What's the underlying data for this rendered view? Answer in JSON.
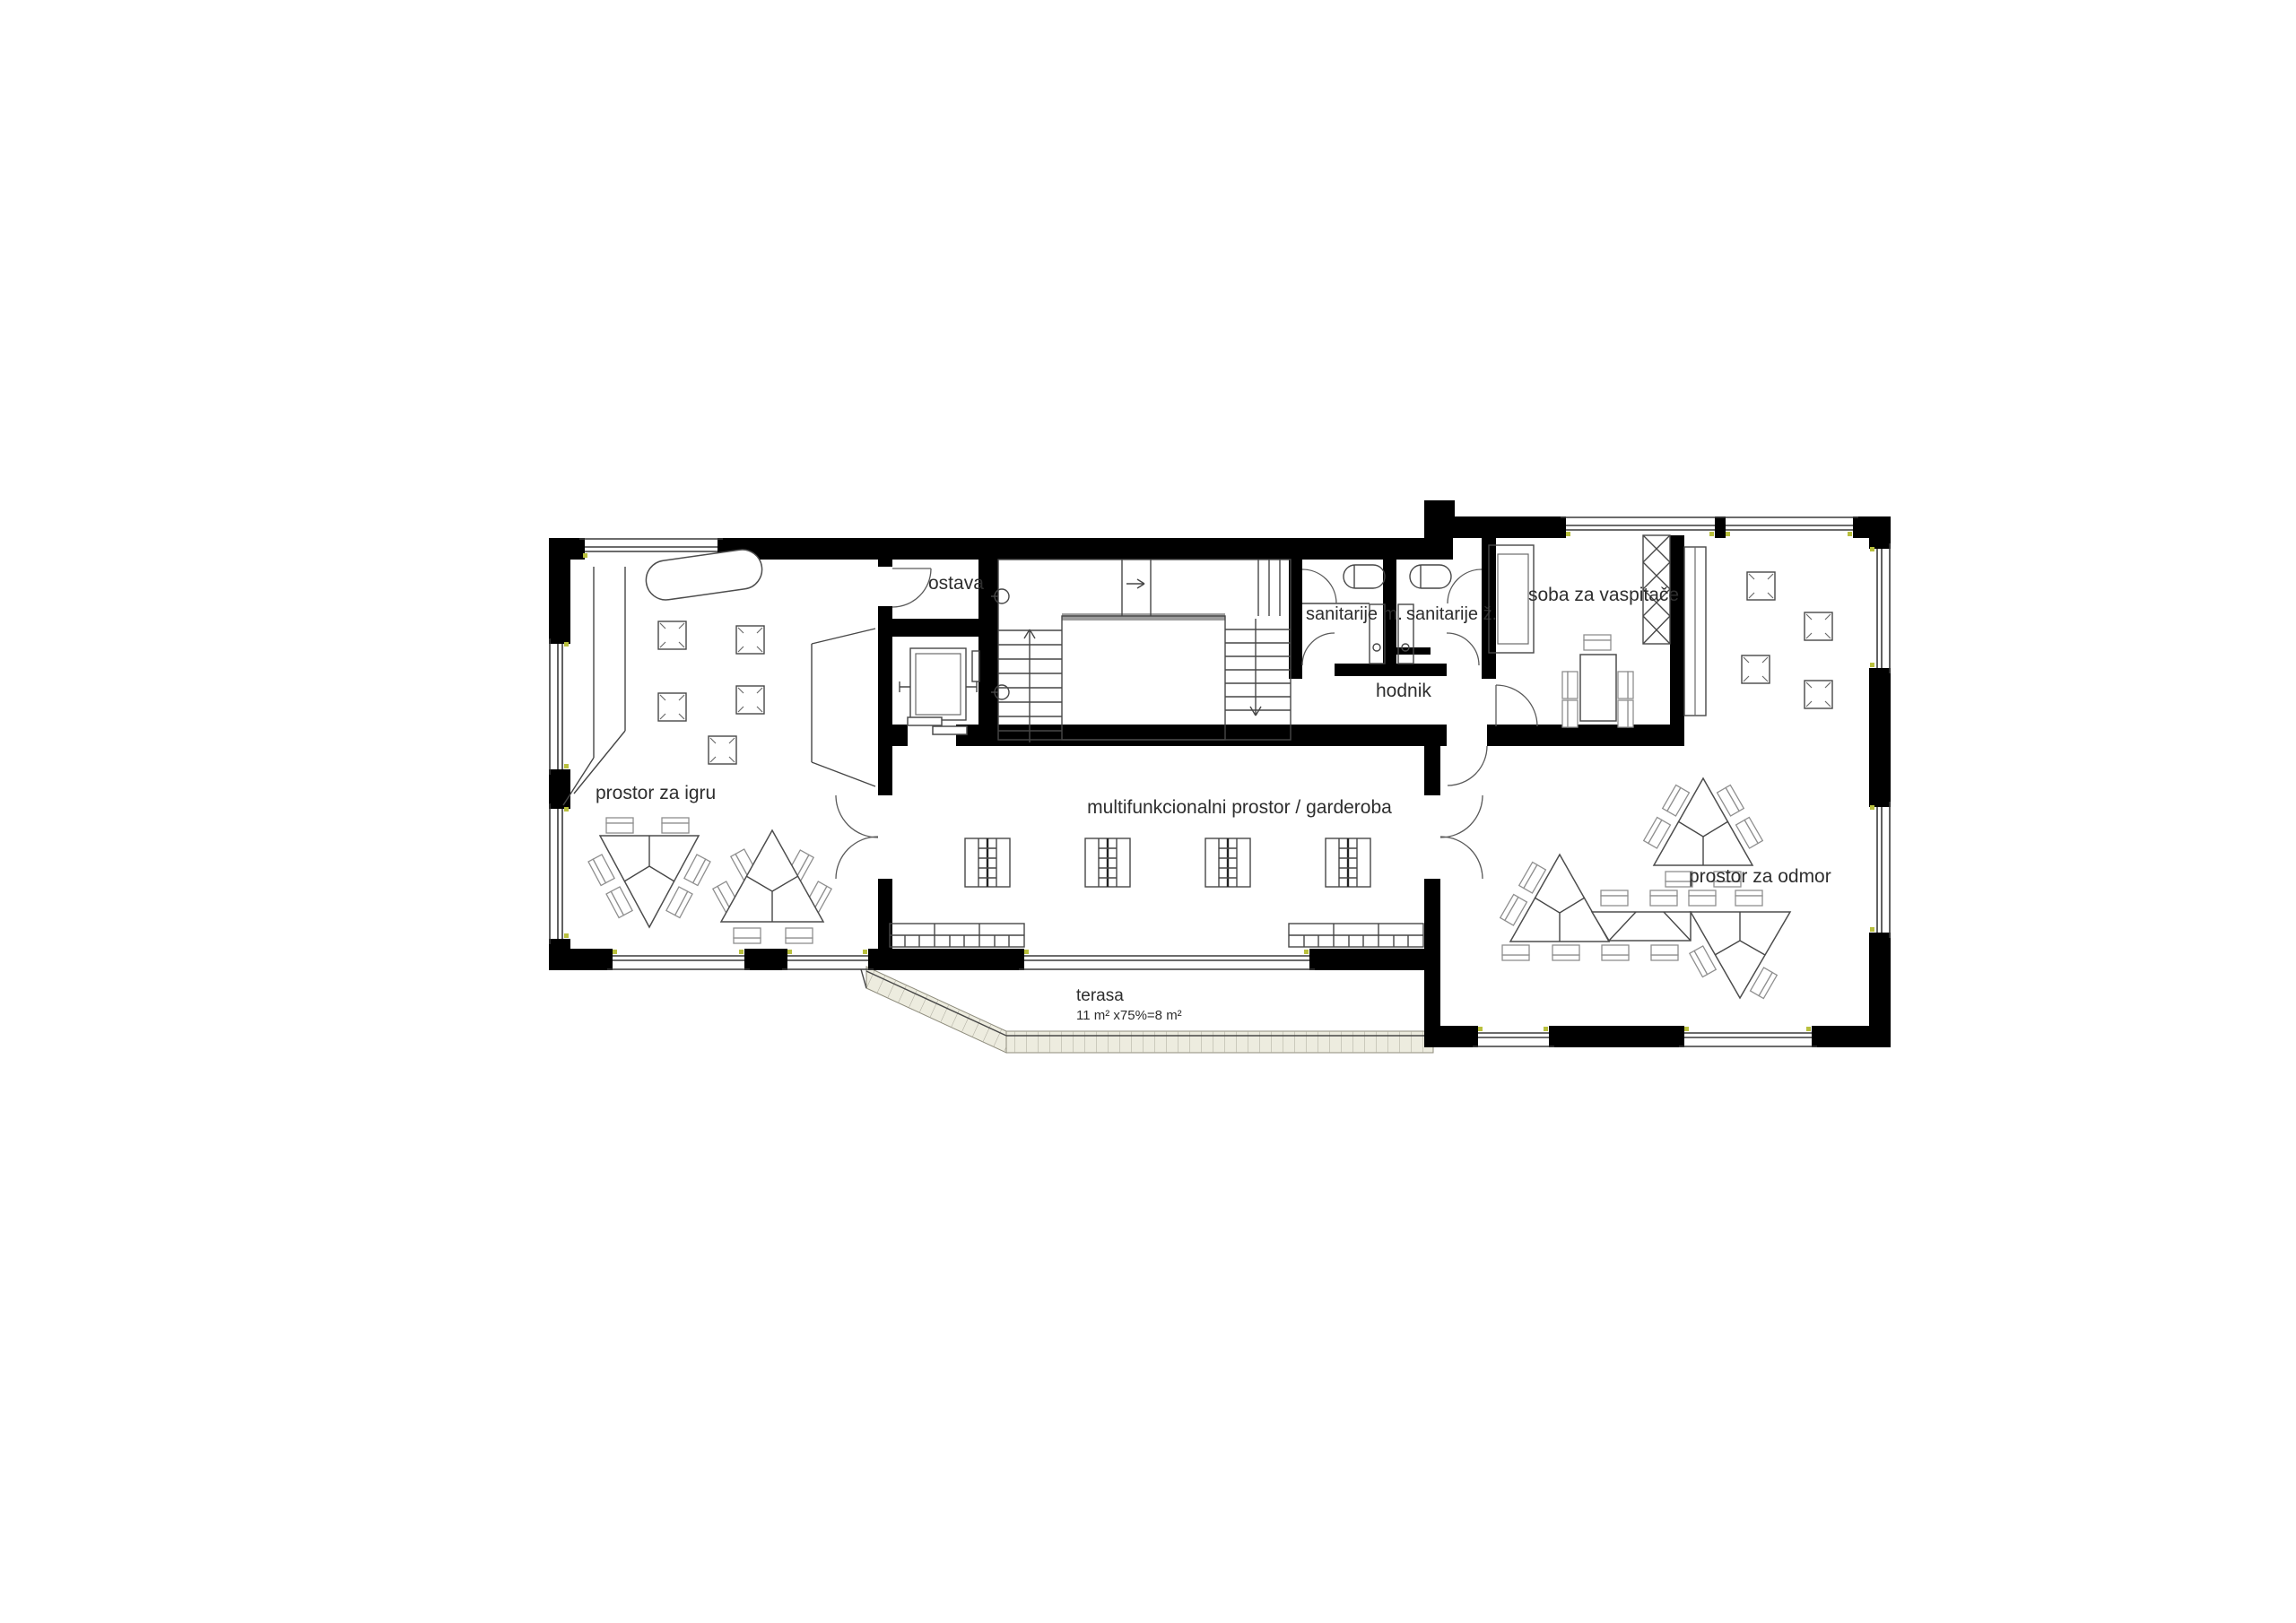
{
  "drawing": {
    "type": "architectural floor plan",
    "labels": {
      "play_room": "prostor za igru",
      "storage": "ostava",
      "sanitary_m": "sanitarije m.",
      "sanitary_f": "sanitarije ž.",
      "teachers_room": "soba za vaspitače",
      "hallway": "hodnik",
      "multi_room": "multifunkcionalni prostor / garderoba",
      "rest_room": "prostor za odmor",
      "terrace": "terasa",
      "terrace_area": "11 m² x75%=8 m²"
    },
    "colors": {
      "wall": "#000000",
      "thin_line": "#474747",
      "furniture_gray": "#8f8f8f",
      "terrace_fill": "#edecdf",
      "marker_dot": "#b9c03d",
      "background": "#ffffff",
      "text": "#2e2e2e"
    }
  }
}
